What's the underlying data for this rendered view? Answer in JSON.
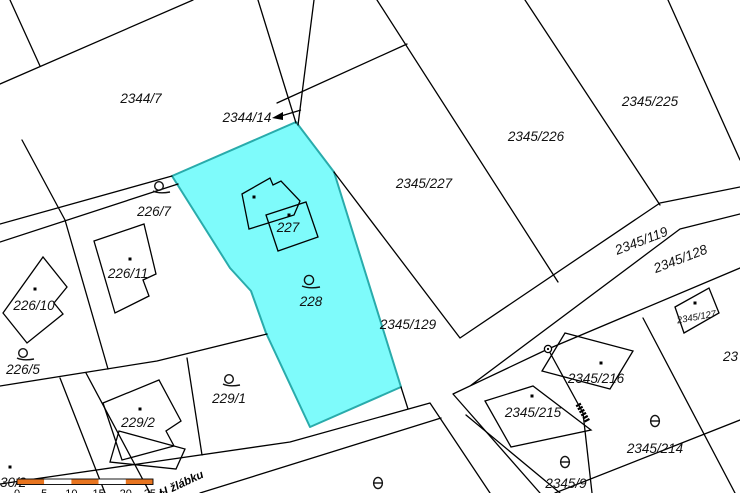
{
  "map_type": "cadastral-parcel-map",
  "colors": {
    "background": "#ffffff",
    "boundary_line": "#000000",
    "highlight_fill": "#7EFBFB",
    "highlight_stroke": "#29ABAB",
    "scale_bar_orange": "#E87520",
    "label_text": "#121212"
  },
  "highlight": {
    "parcels": [
      "227",
      "228"
    ]
  },
  "labels": [
    {
      "text": "2344/7"
    },
    {
      "text": "2344/14"
    },
    {
      "text": "2345/227"
    },
    {
      "text": "2345/226"
    },
    {
      "text": "2345/225"
    },
    {
      "text": "2345/119"
    },
    {
      "text": "2345/128"
    },
    {
      "text": "2345/129"
    },
    {
      "text": "2345/127"
    },
    {
      "text": "23"
    },
    {
      "text": "226/7"
    },
    {
      "text": "226/11"
    },
    {
      "text": "226/10"
    },
    {
      "text": "226/5"
    },
    {
      "text": "229/1"
    },
    {
      "text": "229/2"
    },
    {
      "text": "227"
    },
    {
      "text": "228"
    },
    {
      "text": "2345/216"
    },
    {
      "text": "2345/215"
    },
    {
      "text": "2345/214"
    },
    {
      "text": "2345/9"
    },
    {
      "text": "30/2"
    },
    {
      "text": "U žlábku"
    }
  ],
  "scale_bar": {
    "ticks": [
      "0",
      "5",
      "10",
      "15",
      "20",
      "25 m"
    ]
  },
  "symbols": {
    "building-dot": "small black square marking a building parcel",
    "loop-symbol-icon": "circle with tail (parcel linkage mark)",
    "orchard-symbol-icon": "circle with horizontal bar (land-use mark)",
    "boundary-point-icon": "small ring on boundary line",
    "culvert-symbol-icon": "thick hatched segment on boundary",
    "label-arrow": "arrow pointing from label 2344/14 to its parcel"
  }
}
